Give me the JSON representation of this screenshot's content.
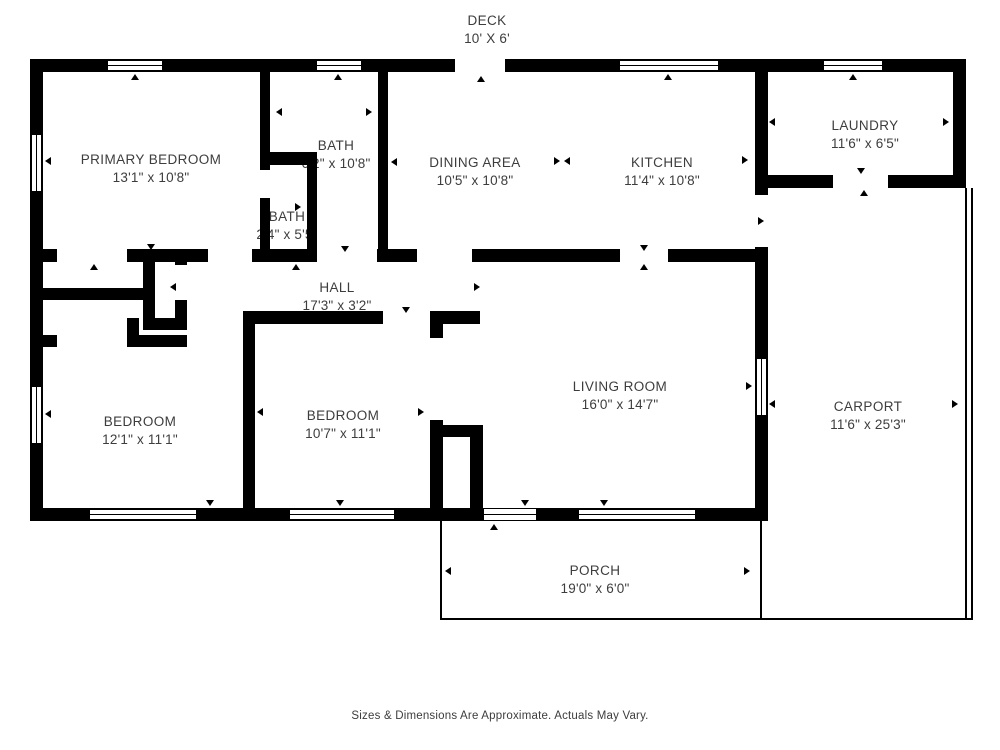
{
  "plan_title": "Floor Plan",
  "rooms": {
    "deck": {
      "name": "DECK",
      "dims": "10' X 6'"
    },
    "primary_bedroom": {
      "name": "PRIMARY BEDROOM",
      "dims": "13'1\" x 10'8\""
    },
    "bath_upper": {
      "name": "BATH",
      "dims": "6'2\" x 10'8\""
    },
    "bath_lower": {
      "name": "BATH",
      "dims": "2'4\" x 5'5\""
    },
    "dining": {
      "name": "DINING AREA",
      "dims": "10'5\" x 10'8\""
    },
    "kitchen": {
      "name": "KITCHEN",
      "dims": "11'4\" x 10'8\""
    },
    "laundry": {
      "name": "LAUNDRY",
      "dims": "11'6\" x 6'5\""
    },
    "hall": {
      "name": "HALL",
      "dims": "17'3\" x 3'2\""
    },
    "bedroom_left": {
      "name": "BEDROOM",
      "dims": "12'1\" x 11'1\""
    },
    "bedroom_middle": {
      "name": "BEDROOM",
      "dims": "10'7\" x 11'1\""
    },
    "living_room": {
      "name": "LIVING ROOM",
      "dims": "16'0\" x 14'7\""
    },
    "carport": {
      "name": "CARPORT",
      "dims": "11'6\" x 25'3\""
    },
    "porch": {
      "name": "PORCH",
      "dims": "19'0\" x 6'0\""
    }
  },
  "footer": {
    "disclaimer": "Sizes & Dimensions Are Approximate. Actuals May Vary."
  },
  "colors": {
    "wall": "#000000",
    "background": "#ffffff",
    "text": "#3d3d3d"
  },
  "icons": {
    "arrow_marker": "small black triangle (door/window indicator)",
    "window": "double-line window symbol"
  }
}
